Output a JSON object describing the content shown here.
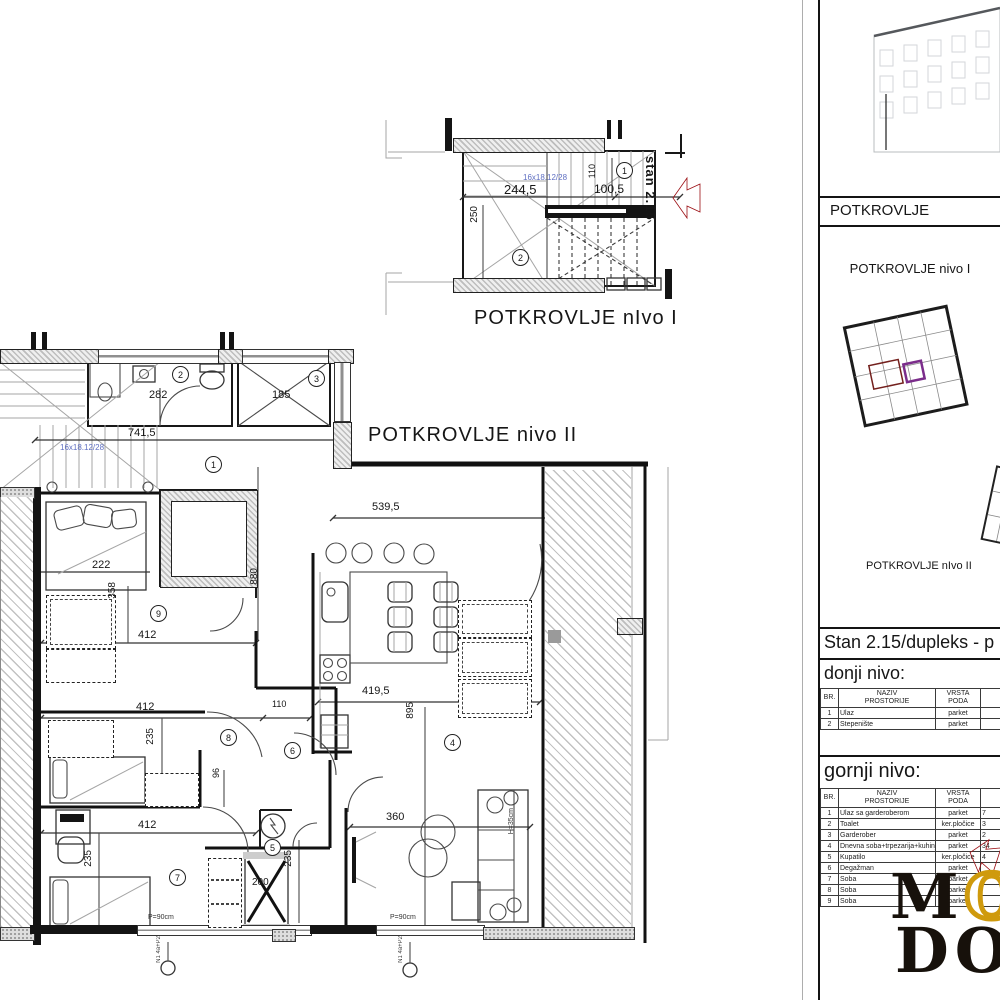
{
  "titles": {
    "plan1_label": "POTKROVLJE nIvo I",
    "plan2_label": "POTKROVLJE nivo II",
    "stan_marker": "stan 2.15"
  },
  "plan1": {
    "stair_note": "16x18.12/28",
    "d_width": "244,5",
    "d_right": "100,5",
    "d_110": "110",
    "d_250": "250",
    "rooms": {
      "r1": "1",
      "r2": "2"
    }
  },
  "plan2": {
    "stair_note": "16x18.12/28",
    "d741": "741,5",
    "d282": "282",
    "d185": "185",
    "d539": "539,5",
    "d222": "222",
    "d358": "358",
    "d880": "880",
    "d412a": "412",
    "d412b": "412",
    "d412c": "412",
    "d419": "419,5",
    "d110": "110",
    "d895": "895",
    "d96": "96",
    "d235a": "235",
    "d235b": "235",
    "d235c": "235",
    "d200": "200",
    "d360": "360",
    "h35": "H=35cm",
    "p90a": "P=90cm",
    "p90b": "P=90cm",
    "n1a": "N1 4a+P2",
    "n1b": "N1 4a+P2",
    "rooms": {
      "r1": "1",
      "r2": "2",
      "r3": "3",
      "r4": "4",
      "r5": "5",
      "r6": "6",
      "r7": "7",
      "r8": "8",
      "r9": "9"
    }
  },
  "panel": {
    "photo_caption": "POTKROVLJE",
    "nivo1_title": "POTKROVLJE nivo I",
    "nivo2_title": "POTKROVLJE nIvo II",
    "stan_line": "Stan 2.15/dupleks - p",
    "lower_heading": "donji nivo:",
    "upper_heading": "gornji nivo:",
    "lower_table": {
      "h": [
        [
          "BR.",
          ""
        ],
        [
          "NAZIV",
          "PROSTORIJE"
        ],
        [
          "VRSTA",
          "PODA"
        ],
        [
          "P",
          ""
        ]
      ],
      "rows": [
        [
          "1",
          "Ulaz",
          "parket",
          ""
        ],
        [
          "2",
          "Stepenište",
          "parket",
          ""
        ]
      ]
    },
    "upper_table": {
      "h": [
        [
          "BR.",
          ""
        ],
        [
          "NAZIV",
          "PROSTORIJE"
        ],
        [
          "VRSTA",
          "PODA"
        ],
        [
          "POVR",
          "PO"
        ]
      ],
      "rows": [
        [
          "1",
          "Ulaz sa garderoberom",
          "parket",
          "7"
        ],
        [
          "2",
          "Toalet",
          "ker.pločice",
          "3"
        ],
        [
          "3",
          "Garderober",
          "parket",
          "2"
        ],
        [
          "4",
          "Dnevna soba+trpezarija+kuhinja",
          "parket",
          "34"
        ],
        [
          "5",
          "Kupatilo",
          "ker.pločice",
          "4"
        ],
        [
          "6",
          "Degažman",
          "parket",
          ""
        ],
        [
          "7",
          "Soba",
          "parket",
          ""
        ],
        [
          "8",
          "Soba",
          "parket",
          ""
        ],
        [
          "9",
          "Soba",
          "parket",
          ""
        ]
      ]
    },
    "watermark_line1": "MO",
    "watermark_line2": "DO"
  },
  "colors": {
    "arrow_red": "#e8131c",
    "note_blue": "#5f6fc2",
    "thumb_room_red": "#b34844",
    "thumb_room_purple": "#7b2d8b",
    "watermark_gold": "#cf9a0d"
  }
}
